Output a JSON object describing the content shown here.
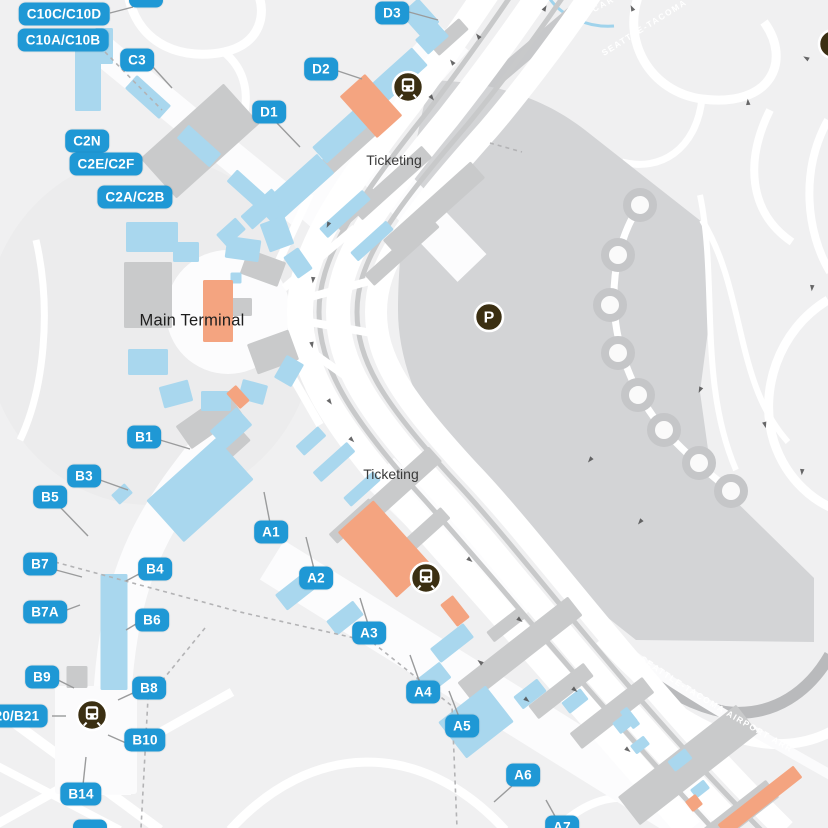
{
  "map": {
    "kind": "airport-terminal-map",
    "airport_name_on_roads": "Seattle-Tacoma"
  },
  "palette": {
    "background": "#f0f0f1",
    "road_white": "#ffffff",
    "badge_blue": "#1f98d5",
    "concourse_blue": "#a9d7ee",
    "building_gray": "#c9cacb",
    "garage_gray": "#d3d4d6",
    "highlight_orange": "#f4a480",
    "icon_dark": "#3b2f12",
    "label_dark": "#1d1d1d",
    "dark_road": "#bdbec0"
  },
  "labels": {
    "main_terminal": "Main Terminal",
    "ticketing_north": "Ticketing",
    "ticketing_south": "Ticketing"
  },
  "road_labels": {
    "air_cargo": "AIR CARGO",
    "hwy_north": "SEATTLE-TACOMA",
    "arrivals": "SEATTLE-TACOMA AIRPORT ARR"
  },
  "gates": [
    {
      "id": "c10cd",
      "label": "C10C/C10D"
    },
    {
      "id": "c10ab",
      "label": "C10A/C10B"
    },
    {
      "id": "c3",
      "label": "C3"
    },
    {
      "id": "c2n",
      "label": "C2N"
    },
    {
      "id": "c2ef",
      "label": "C2E/C2F"
    },
    {
      "id": "c2ab",
      "label": "C2A/C2B"
    },
    {
      "id": "d3",
      "label": "D3"
    },
    {
      "id": "d2",
      "label": "D2"
    },
    {
      "id": "d1",
      "label": "D1"
    },
    {
      "id": "b1",
      "label": "B1"
    },
    {
      "id": "b3",
      "label": "B3"
    },
    {
      "id": "b5",
      "label": "B5"
    },
    {
      "id": "b7",
      "label": "B7"
    },
    {
      "id": "b4",
      "label": "B4"
    },
    {
      "id": "b7a",
      "label": "B7A"
    },
    {
      "id": "b6",
      "label": "B6"
    },
    {
      "id": "b9",
      "label": "B9"
    },
    {
      "id": "b8",
      "label": "B8"
    },
    {
      "id": "b20b21",
      "label": "B20/B21"
    },
    {
      "id": "b10",
      "label": "B10"
    },
    {
      "id": "b14",
      "label": "B14"
    },
    {
      "id": "a1",
      "label": "A1"
    },
    {
      "id": "a2",
      "label": "A2"
    },
    {
      "id": "a3",
      "label": "A3"
    },
    {
      "id": "a4",
      "label": "A4"
    },
    {
      "id": "a5",
      "label": "A5"
    },
    {
      "id": "a6",
      "label": "A6"
    },
    {
      "id": "a7",
      "label": "A7"
    },
    {
      "id": "ptop",
      "label": ""
    },
    {
      "id": "pbot",
      "label": ""
    }
  ],
  "markers": [
    {
      "id": "train-north",
      "type": "train"
    },
    {
      "id": "train-south",
      "type": "train"
    },
    {
      "id": "train-b-satellite",
      "type": "train"
    },
    {
      "id": "parking-main",
      "type": "parking",
      "glyph": "P"
    },
    {
      "id": "parking-edge",
      "type": "parking",
      "glyph": "P"
    }
  ]
}
